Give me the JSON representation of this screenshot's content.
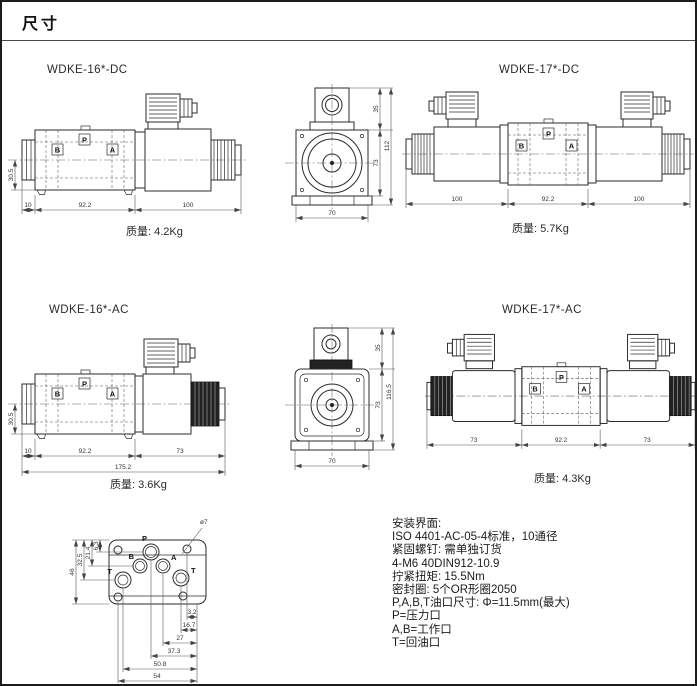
{
  "page": {
    "title": "尺寸"
  },
  "ports": {
    "b": "B",
    "p": "P",
    "a": "A"
  },
  "drawings": {
    "dc16": {
      "title": "WDKE-16*-DC",
      "mass": "质量: 4.2Kg",
      "dims": {
        "cap": "10",
        "body": "92.2",
        "solenoid": "100",
        "height": "30.5"
      }
    },
    "dc17": {
      "title": "WDKE-17*-DC",
      "mass": "质量: 5.7Kg",
      "dims": {
        "left": "100",
        "body": "92.2",
        "right": "100"
      }
    },
    "ac16": {
      "title": "WDKE-16*-AC",
      "mass": "质量: 3.6Kg",
      "dims": {
        "cap": "10",
        "body": "92.2",
        "solenoid": "73",
        "total": "175.2",
        "height": "30.5"
      }
    },
    "ac17": {
      "title": "WDKE-17*-AC",
      "mass": "质量: 4.3Kg",
      "dims": {
        "left": "73",
        "body": "92.2",
        "right": "73"
      }
    },
    "end_dc": {
      "dims": {
        "connector": "35",
        "body": "73",
        "total": "112",
        "width": "70"
      }
    },
    "end_ac": {
      "dims": {
        "connector": "35",
        "body": "73",
        "total": "116.5",
        "width": "70"
      }
    }
  },
  "mounting": {
    "hole_dia": "ø7",
    "port_p": "P",
    "port_b": "B",
    "port_a": "A",
    "port_t_left": "T",
    "port_t_right": "T",
    "dims_vertical": [
      "6.3",
      "21.4",
      "32.5",
      "46"
    ],
    "dims_horizontal": [
      "3.2",
      "16.7",
      "27",
      "37.3",
      "50.8",
      "54"
    ]
  },
  "specs": {
    "lines": [
      "安装界面:",
      "ISO 4401-AC-05-4标准，10通径",
      "紧固螺钉: 需单独订货",
      "4-M6 40DIN912-10.9",
      "拧紧扭矩: 15.5Nm",
      "密封圈: 5个OR形圈2050",
      "P,A,B,T油口尺寸: Φ=11.5mm(最大)",
      "P=压力口",
      "A,B=工作口",
      "T=回油口"
    ]
  }
}
